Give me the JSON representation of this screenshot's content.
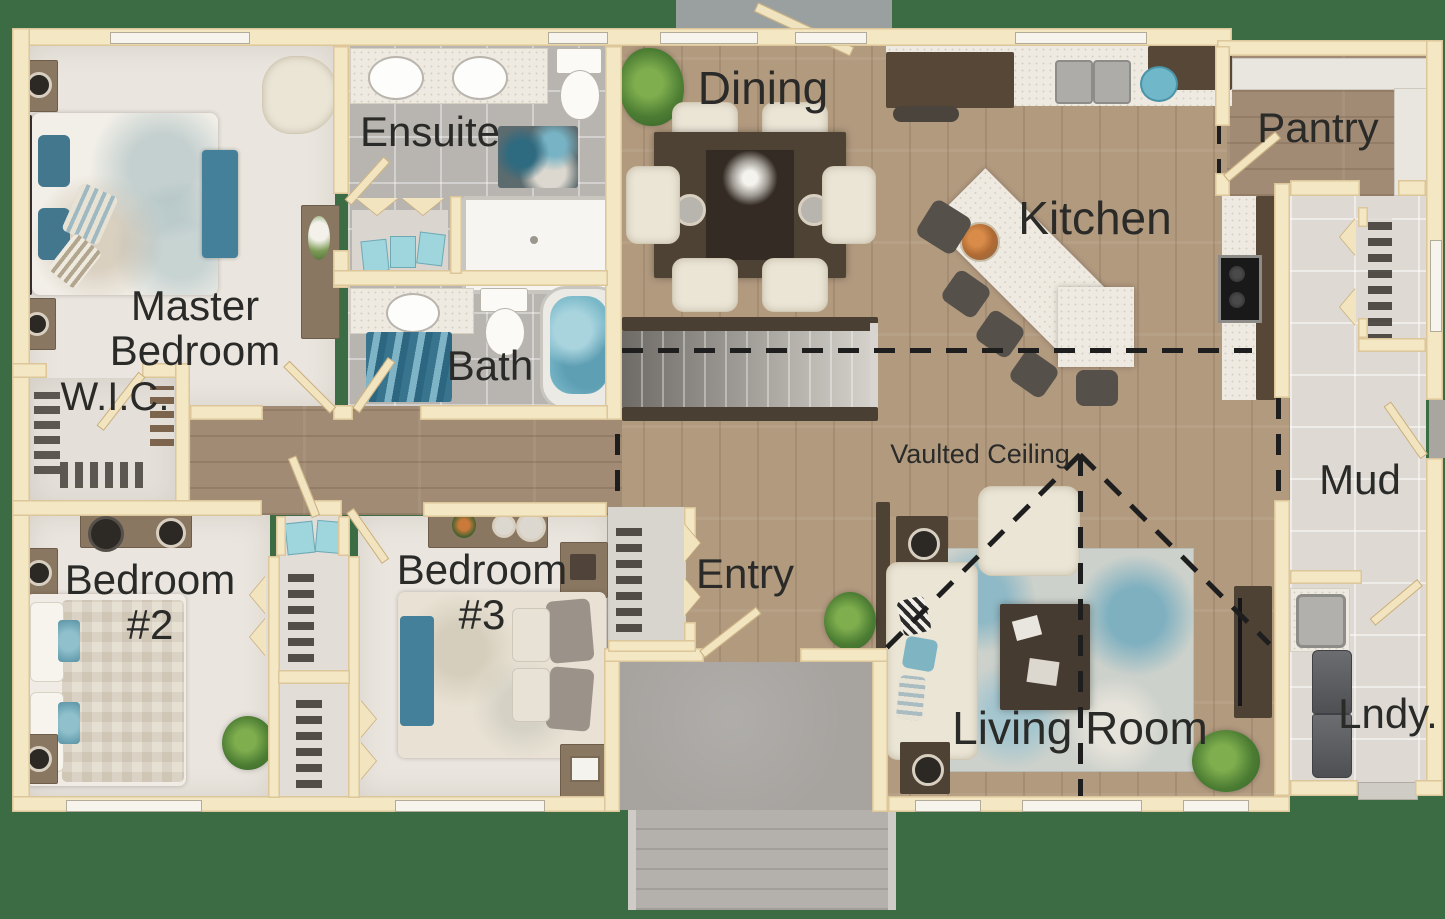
{
  "scene": {
    "type": "floor-plan",
    "description": "Top-down 3D rendered single-storey house floor plan on green background"
  },
  "rooms": {
    "master": {
      "label": "Master Bedroom"
    },
    "wic": {
      "label": "W.I.C."
    },
    "ensuite": {
      "label": "Ensuite"
    },
    "bath": {
      "label": "Bath"
    },
    "bedroom2": {
      "label": "Bedroom #2"
    },
    "bedroom3": {
      "label": "Bedroom #3"
    },
    "entry": {
      "label": "Entry"
    },
    "dining": {
      "label": "Dining"
    },
    "kitchen": {
      "label": "Kitchen"
    },
    "pantry": {
      "label": "Pantry"
    },
    "mud": {
      "label": "Mud"
    },
    "laundry": {
      "label": "Lndy."
    },
    "living": {
      "label": "Living Room"
    }
  },
  "annotations": {
    "vaulted_ceiling": {
      "label": "Vaulted Ceiling"
    }
  },
  "colors": {
    "background": "#3c6c44",
    "wall": "#f4e7c3",
    "wood_floor": "#b29a7f",
    "hall_wood": "#a28b74",
    "carpet": "#eae6df",
    "tile": "#b8b5b1",
    "tile_light": "#dedad3",
    "counter": "#eeeae1",
    "furniture_dark_wood": "#50433a",
    "furniture_mid_wood": "#8a7762",
    "accent_teal": "#44809a",
    "accent_teal_light": "#9fd6de",
    "annotation_line": "#1e1e1e",
    "label_text": "#2a2a28"
  }
}
